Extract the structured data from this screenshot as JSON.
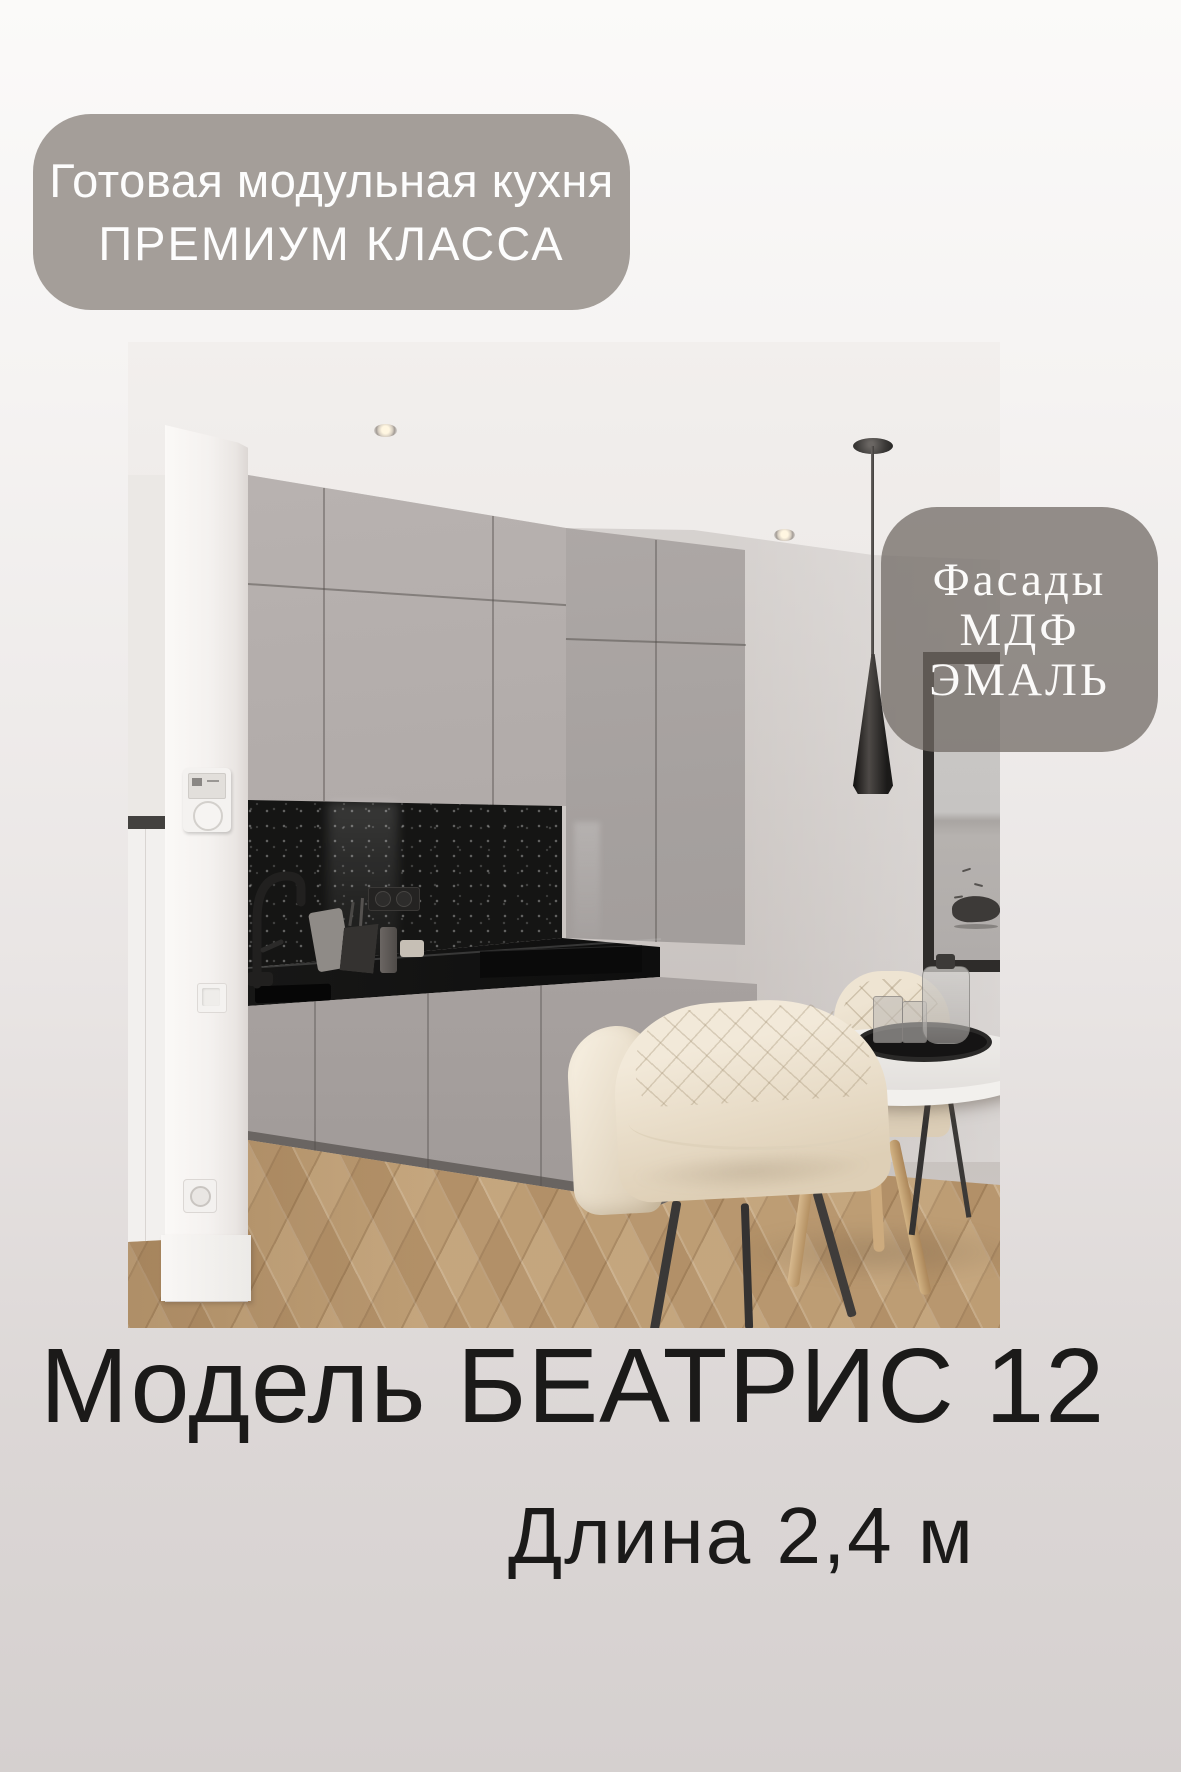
{
  "poster": {
    "top_badge": {
      "line1": "Готовая модульная кухня",
      "line2": "ПРЕМИУМ КЛАССА"
    },
    "side_badge": {
      "line1": "Фасады",
      "line2": "МДФ",
      "line3": "ЭМАЛЬ"
    },
    "title": "Модель БЕАТРИС 12",
    "subtitle": "Длина 2,4 м",
    "colors": {
      "top_badge_bg": "#a49e99",
      "side_badge_overlay": "rgba(112,105,100,0.74)",
      "badge_text": "#fdfdfd",
      "title_text": "#1b1a19",
      "background_top": "#fbfaf9",
      "background_bottom": "#d5d0cf"
    }
  },
  "photo": {
    "subject": "kitchen-interior-render",
    "palette": {
      "cabinet_greige": "#aea8a6",
      "backsplash_black": "#151514",
      "countertop_black": "#111111",
      "wall_gray": "#cdc7c4",
      "ceiling_white": "#efecea",
      "floor_wood": "#bd9d74",
      "chair_cream": "#e9dfcd",
      "table_white": "#edebe8",
      "wood_leg": "#c9a87c",
      "column_white": "#f5f2f0"
    }
  }
}
